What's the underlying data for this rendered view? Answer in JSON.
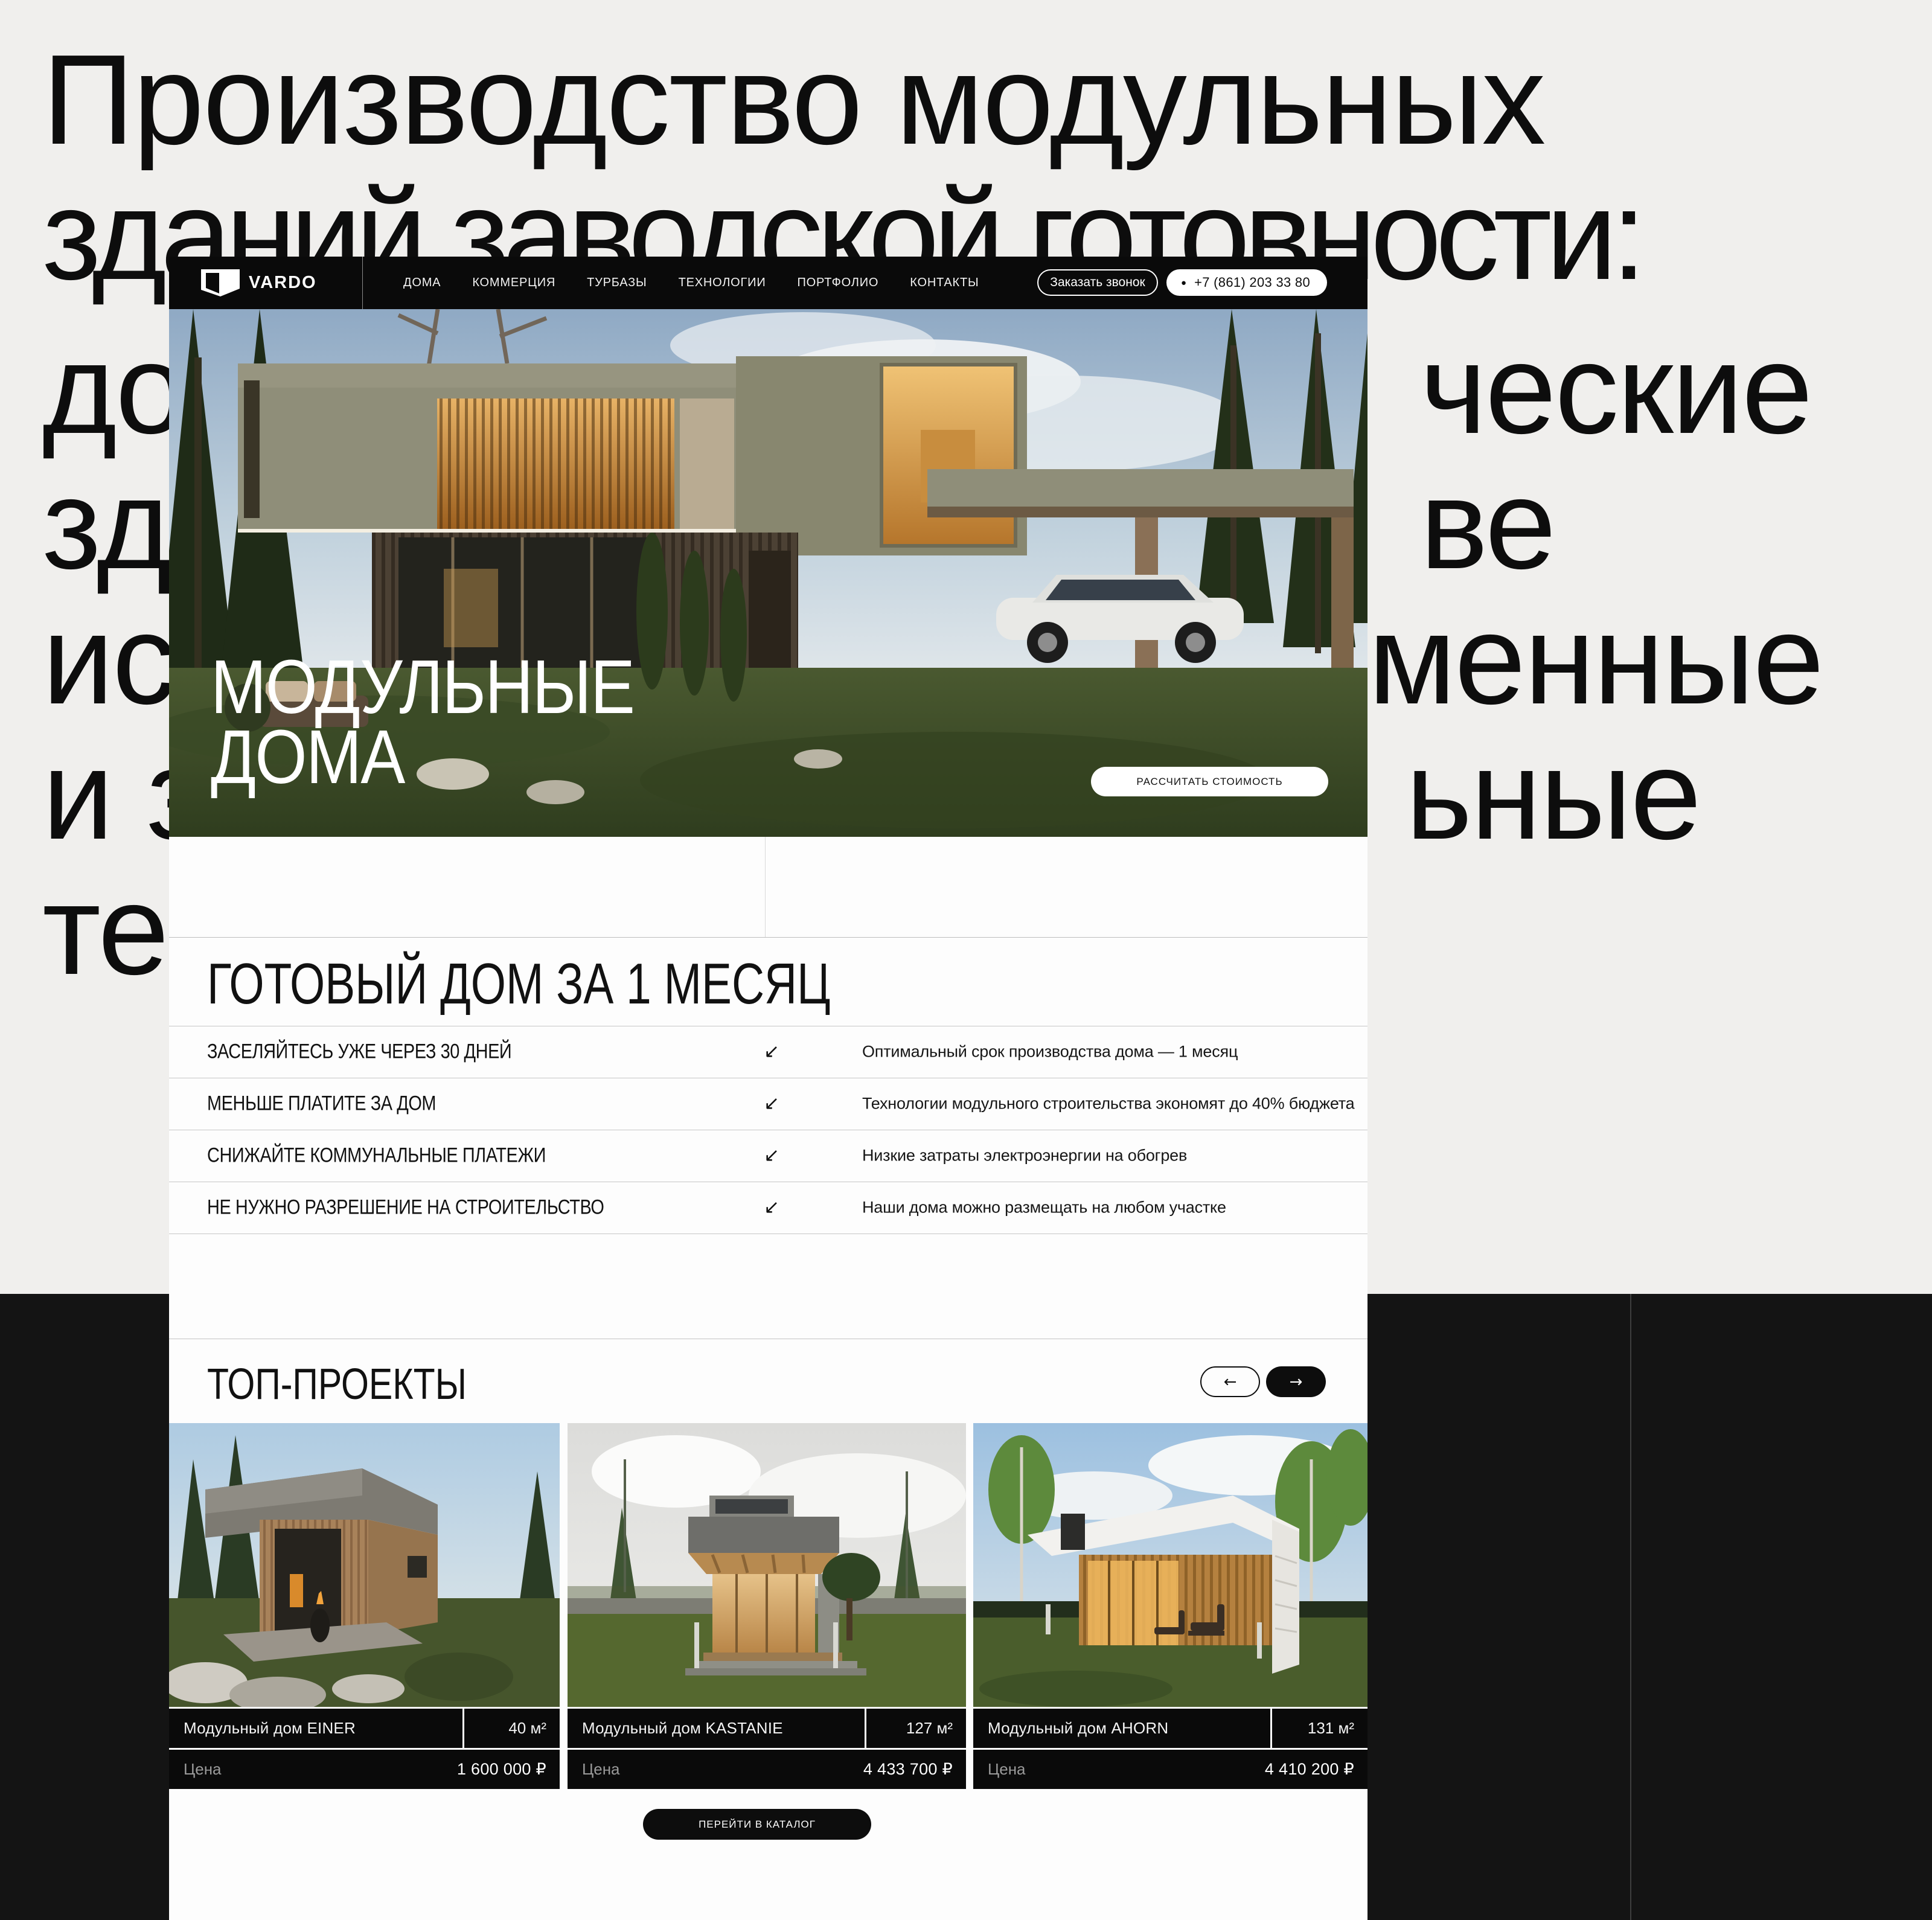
{
  "background": {
    "line1": "Производство модульных",
    "line2": "зданий заводской готовности:",
    "fragments": {
      "left": [
        "до",
        "зд",
        "ис",
        "и з",
        "те"
      ],
      "right": [
        "ческие",
        "ве",
        "менные",
        "ьные"
      ]
    }
  },
  "site": {
    "nav": {
      "brand": "VARDO",
      "items": [
        "ДОМА",
        "КОММЕРЦИЯ",
        "ТУРБАЗЫ",
        "ТЕХНОЛОГИИ",
        "ПОРТФОЛИО",
        "КОНТАКТЫ"
      ],
      "call_button": "Заказать звонок",
      "phone": "+7 (861) 203 33 80"
    },
    "hero": {
      "title_line1": "МОДУЛЬНЫЕ",
      "title_line2": "ДОМА",
      "cost_button": "РАССЧИТАТЬ СТОИМОСТЬ"
    },
    "benefits": {
      "heading": "ГОТОВЫЙ ДОМ ЗА 1 МЕСЯЦ",
      "rows": [
        {
          "label": "ЗАСЕЛЯЙТЕСЬ УЖЕ ЧЕРЕЗ 30 ДНЕЙ",
          "desc": "Оптимальный срок производства дома — 1 месяц"
        },
        {
          "label": "МЕНЬШЕ ПЛАТИТЕ ЗА ДОМ",
          "desc": "Технологии модульного строительства экономят до 40% бюджета"
        },
        {
          "label": "СНИЖАЙТЕ КОММУНАЛЬНЫЕ ПЛАТЕЖИ",
          "desc": "Низкие затраты электроэнергии на обогрев"
        },
        {
          "label": "НЕ НУЖНО РАЗРЕШЕНИЕ НА СТРОИТЕЛЬСТВО",
          "desc": "Наши дома можно размещать на любом участке"
        }
      ]
    },
    "projects": {
      "heading": "ТОП-ПРОЕКТЫ",
      "price_label": "Цена",
      "cards": [
        {
          "name": "Модульный дом EINER",
          "area": "40 м²",
          "price": "1 600 000 ₽"
        },
        {
          "name": "Модульный дом KASTANIE",
          "area": "127 м²",
          "price": "4 433 700 ₽"
        },
        {
          "name": "Модульный дом AHORN",
          "area": "131 м²",
          "price": "4 410 200 ₽"
        }
      ],
      "catalog_button": "ПЕРЕЙТИ В КАТАЛОГ"
    },
    "icons": {
      "arrow_sw": "↙",
      "arrow_left": "←",
      "arrow_right": "→",
      "dot": "●"
    },
    "colors": {
      "nav_black": "#0a0a0a",
      "page_gray": "#f0efed",
      "page_black": "#141414"
    }
  }
}
